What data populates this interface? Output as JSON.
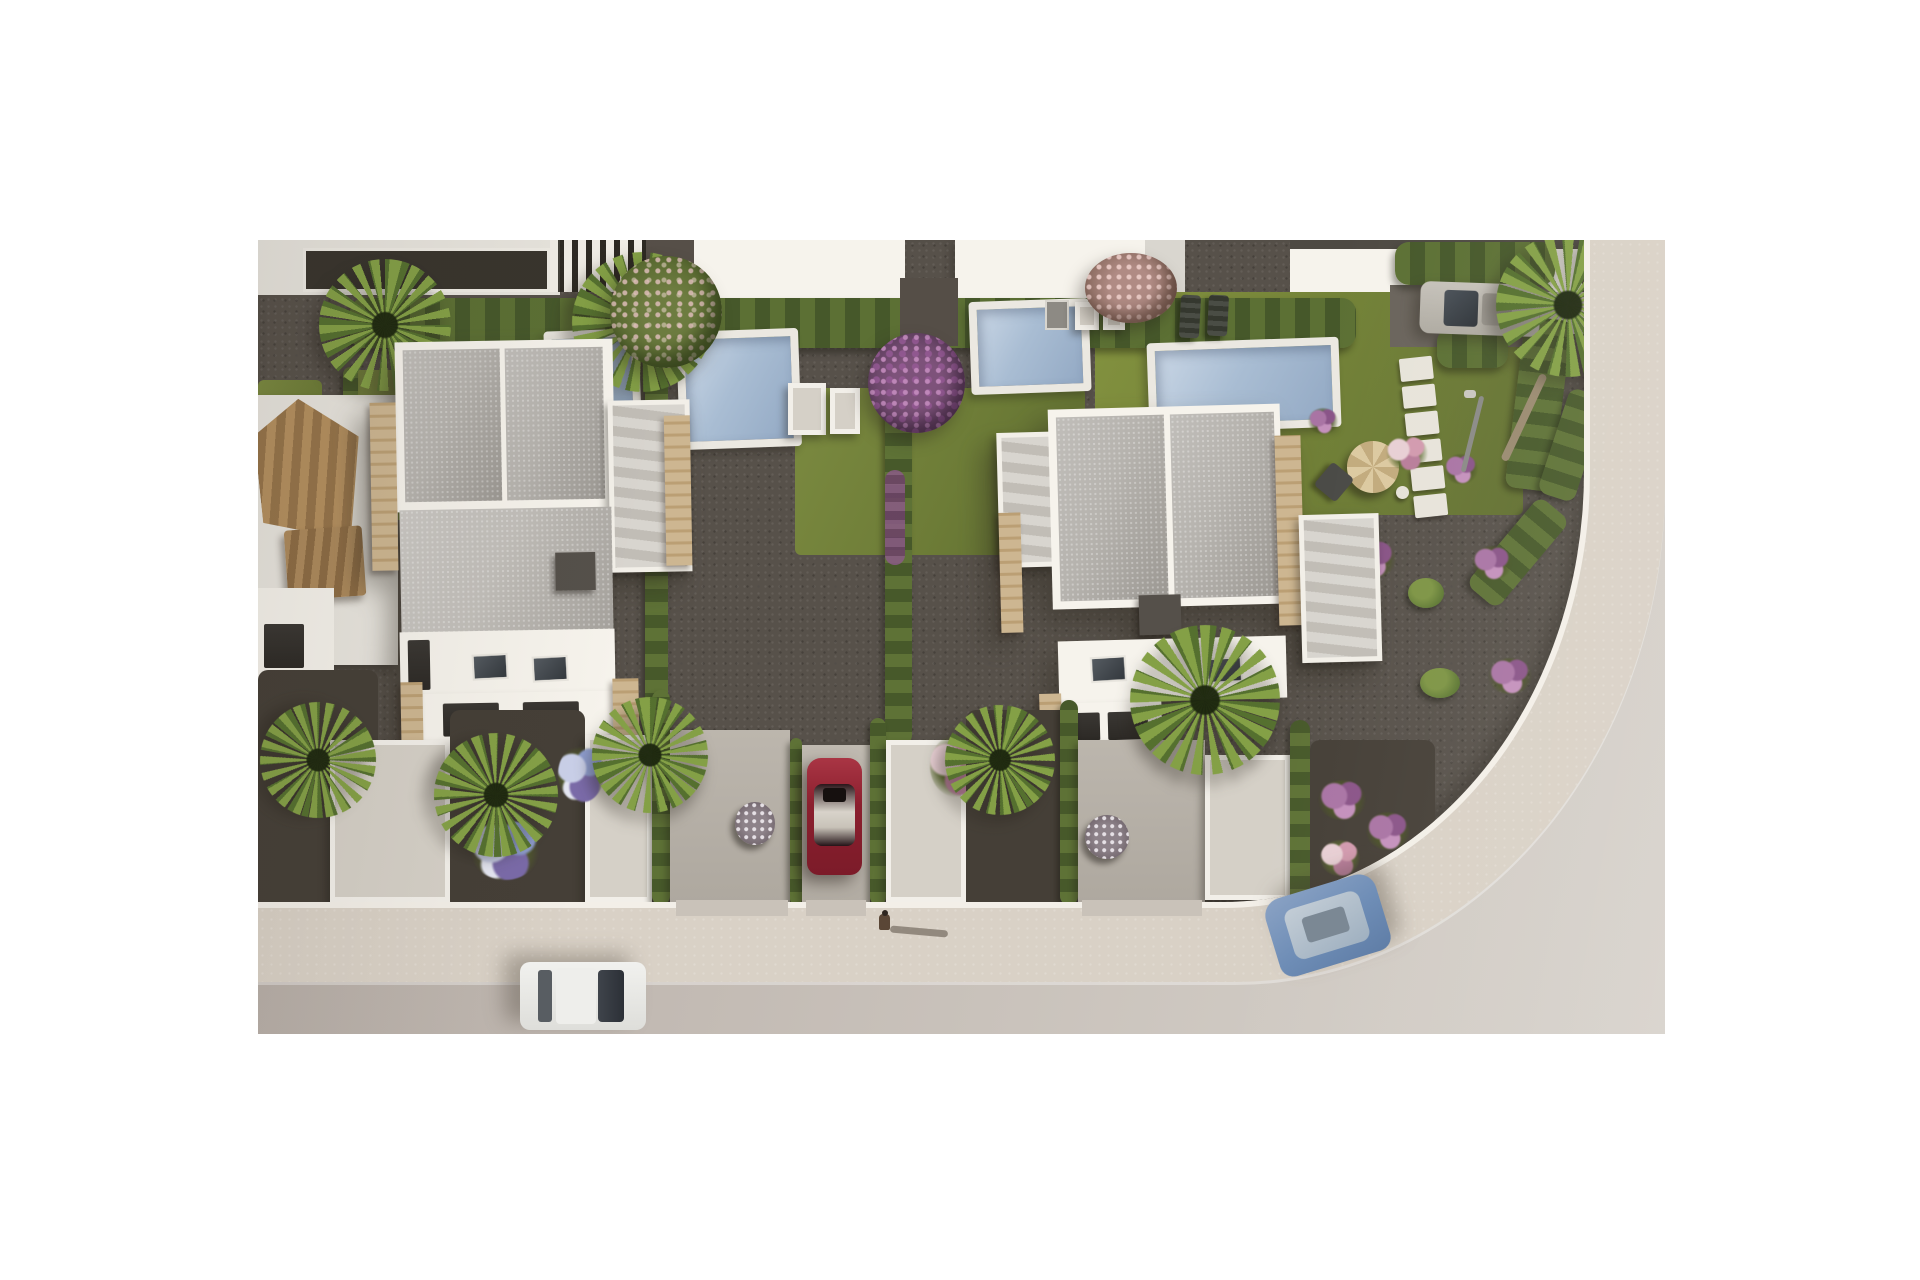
{
  "scene": {
    "type": "architectural-aerial-render",
    "description": "Aerial 3D rendering of a modern Mediterranean villa development: two white flat-roofed villas with beige stone accents and private pools, landscaped gardens with palm trees, cypress hedges and flowering shrubs, gravel paths, hedged driveways (one with a parked red car), a row of partially visible houses at the top, an older tile-roofed house at the left, and a curved light street at the bottom right with a white car, a blue car, a parked silver car and a pedestrian on the sidewalk.",
    "counts": {
      "villas": 2,
      "pools": 4,
      "cars": 4,
      "pedestrians": 1,
      "palm_trees": 7
    },
    "cars": [
      {
        "name": "red-car",
        "color": "#8b1f2e",
        "location": "driveway between hedges"
      },
      {
        "name": "white-car",
        "color": "#ecece9",
        "location": "street bottom left"
      },
      {
        "name": "blue-car",
        "color": "#7090ba",
        "location": "street right bend"
      },
      {
        "name": "silver-car",
        "color": "#bcb8af",
        "location": "top right driveway"
      }
    ],
    "palette": {
      "page_background": "#ffffff",
      "road": "#c3bbb4",
      "sidewalk": "#d9d1c6",
      "gravel": "#57514a",
      "lawn": "#6d7c37",
      "hedge": "#4a5c2a",
      "pool_water": "#a9bdd3",
      "villa_white": "#f6f3ec",
      "roof_gray": "#b6b3ae",
      "stone_beige": "#cdb691",
      "tile_roof_brown": "#ad8a5c"
    }
  }
}
